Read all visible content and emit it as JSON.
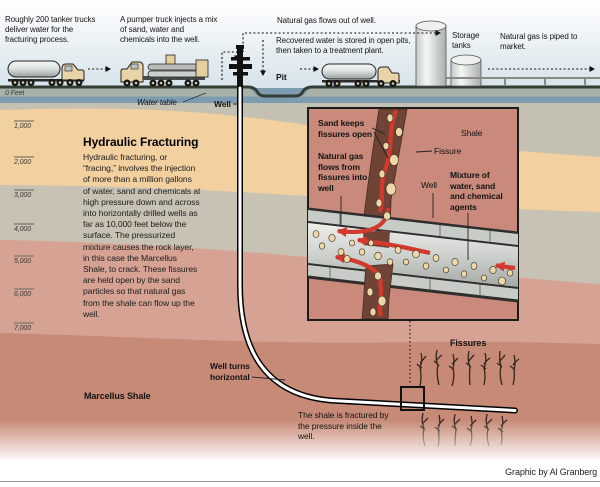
{
  "credit": "Graphic by Al Granberg",
  "surface": {
    "tanker_caption": "Roughly 200 tanker trucks deliver water for the fracturing process.",
    "pumper_caption": "A pumper truck injects a mix of sand, water and chemicals into the well.",
    "gas_out_caption": "Natural gas flows out of well.",
    "recovered_caption": "Recovered water is stored in open pits, then taken to a treatment plant.",
    "pit_label": "Pit",
    "storage_tanks_label": "Storage tanks",
    "piped_caption": "Natural gas is piped to market."
  },
  "underground": {
    "water_table_label": "Water table",
    "well_label": "Well",
    "heading": "Hydraulic Fracturing",
    "body": "Hydraulic fracturing, or “fracing,” involves the injection of more than a million gallons of water, sand and chemicals at high pressure down and across into horizontally drilled wells as far as 10,000 feet below the surface. The pressurized mixture causes the rock layer, in this case the Marcellus Shale, to crack. These fissures are held open by the sand particles so that natural gas from the shale can flow up the well.",
    "well_turns_label": "Well turns horizontal",
    "marcellus_label": "Marcellus Shale",
    "fissures_label": "Fissures",
    "fractured_caption": "The shale is fractured by the pressure inside the well."
  },
  "inset": {
    "sand_label": "Sand keeps fissures open",
    "shale_label": "Shale",
    "fissure_label": "Fissure",
    "gas_flow_label": "Natural gas flows from fissures into well",
    "well_label": "Well",
    "mixture_label": "Mixture of water, sand and chemical agents"
  },
  "depth_scale": [
    "0 Feet",
    "1,000",
    "2,000",
    "3,000",
    "4,000",
    "5,000",
    "6,000",
    "7,000"
  ],
  "colors": {
    "sky": "#d7e4ec",
    "topsoil_gray": "#c4c0b2",
    "sand_layer_peach": "#f3d0a0",
    "rock_gray": "#c8c2b4",
    "salmon_rock": "#d6a294",
    "marcellus_shale": "#c78a76",
    "water_table_blue": "#7d9cb0",
    "fissure_brown": "#6f4336",
    "gas_red": "#d23a2e",
    "sand_particle": "#ecd7a9"
  }
}
